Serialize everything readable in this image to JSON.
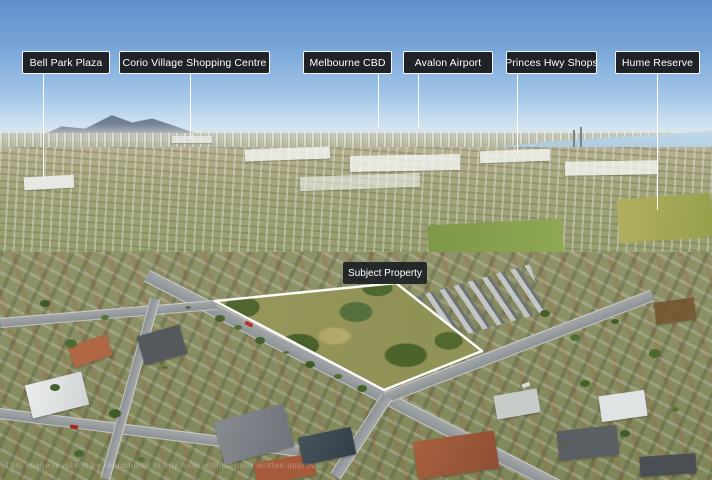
{
  "scene": {
    "description": "Oblique aerial drone photograph of a suburban area; subject property parcel outlined in white with landmark direction flags on the horizon"
  },
  "landmark_labels": [
    {
      "label": "Bell Park Plaza"
    },
    {
      "label": "Corio Village Shopping Centre"
    },
    {
      "label": "Melbourne CBD"
    },
    {
      "label": "Avalon Airport"
    },
    {
      "label": "Princes Hwy Shops"
    },
    {
      "label": "Hume Reserve"
    }
  ],
  "subject_property": {
    "label": "Subject Property"
  },
  "watermark": {
    "text": "This image must not be reproduced in any form without prior written approval"
  },
  "colors": {
    "label_background": "#1f2226",
    "label_border": "#ffffff",
    "label_text": "#ffffff",
    "boundary_outline": "#ffffff",
    "sky": "#6a9bd3",
    "bay_water": "#9fc2da",
    "park_green": "#8f9156"
  }
}
